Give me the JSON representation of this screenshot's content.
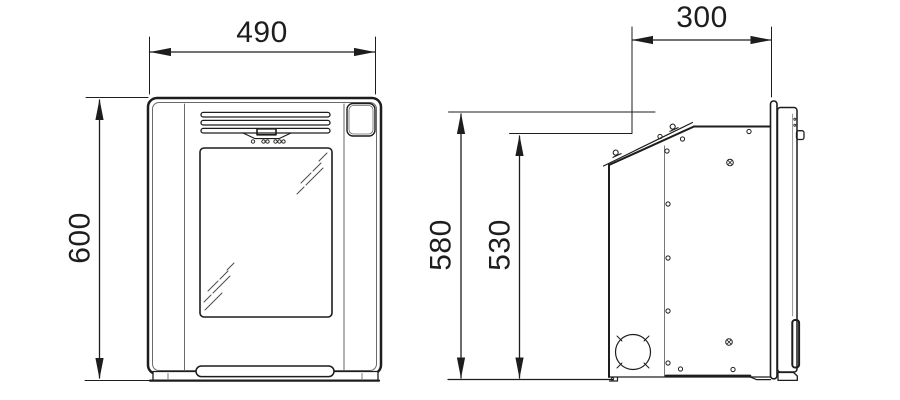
{
  "diagram": {
    "type": "technical-dimension-drawing",
    "subject": "wall-mounted appliance, front view and side view",
    "labels": {
      "front_width": "490",
      "front_height": "600",
      "side_depth": "300",
      "side_height_overall": "580",
      "side_height_back": "530"
    },
    "units_shown": "none (numeric only)",
    "colors": {
      "line": "#1d1d1b",
      "thin_line": "#6a6a6a",
      "background": "#ffffff"
    }
  }
}
